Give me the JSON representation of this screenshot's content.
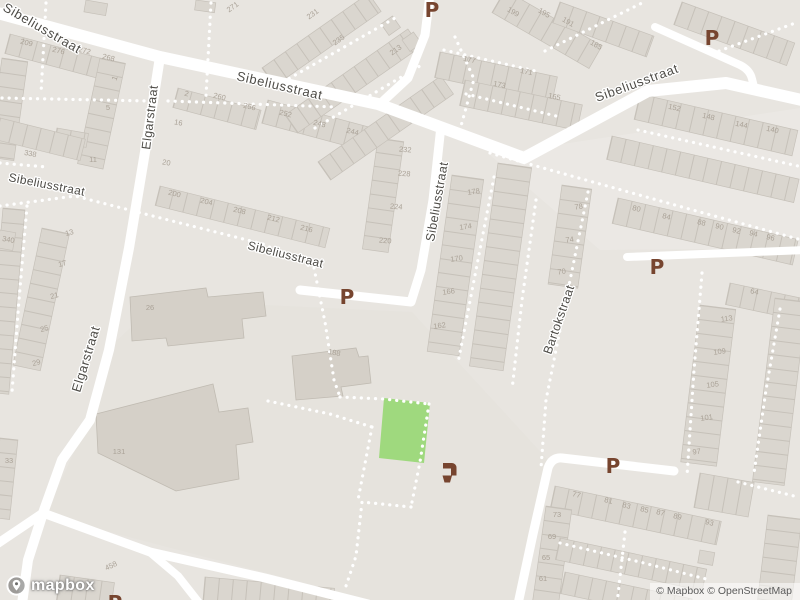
{
  "map_overlays": {
    "logo_text": "mapbox",
    "attribution_text": "© Mapbox © OpenStreetMap"
  },
  "colors": {
    "parking": "#77452f",
    "amenity": "#77452f",
    "park": "#9fd97e",
    "road": "#ffffff",
    "street_label": "#4e4c47",
    "house_number": "#aaa297"
  },
  "street_labels": [
    {
      "text": "Sibeliusstraat",
      "x": 2,
      "y": 10,
      "rotate": 30,
      "size": 13,
      "spacing": 0.7
    },
    {
      "text": "Sibeliusstraat",
      "x": 236,
      "y": 80,
      "rotate": 13,
      "size": 13,
      "spacing": 0.7
    },
    {
      "text": "Sibeliusstraat",
      "x": 597,
      "y": 102,
      "rotate": -20,
      "size": 13,
      "spacing": 0.7
    },
    {
      "text": "Sibeliusstraat",
      "x": 8,
      "y": 181,
      "rotate": 11,
      "size": 12,
      "spacing": 0.4
    },
    {
      "text": "Sibeliusstraat",
      "x": 247,
      "y": 249,
      "rotate": 14,
      "size": 12,
      "spacing": 0.4
    },
    {
      "text": "Sibeliusstraat",
      "x": 434,
      "y": 242,
      "rotate": -80,
      "size": 12.5,
      "spacing": 0.4
    },
    {
      "text": "Elgarstraat",
      "x": 150,
      "y": 150,
      "rotate": -83,
      "size": 12.5,
      "spacing": 0.4
    },
    {
      "text": "Elgarstraat",
      "x": 80,
      "y": 393,
      "rotate": -73,
      "size": 13,
      "spacing": 0.5
    },
    {
      "text": "Bartokstraat",
      "x": 551,
      "y": 355,
      "rotate": -71,
      "size": 12.5,
      "spacing": 0.4
    }
  ],
  "parking_glyph": "P",
  "parking_labels": [
    {
      "x": 432,
      "y": 10
    },
    {
      "x": 712,
      "y": 38
    },
    {
      "x": 347,
      "y": 297
    },
    {
      "x": 657,
      "y": 267
    },
    {
      "x": 613,
      "y": 466
    },
    {
      "x": 115,
      "y": 603
    }
  ],
  "amenity_icons": [
    {
      "name": "drinking-water-icon",
      "x": 452,
      "y": 472
    }
  ],
  "house_numbers": [
    {
      "t": "209",
      "x": 26,
      "y": 45,
      "r": 14
    },
    {
      "t": "276",
      "x": 58,
      "y": 53,
      "r": 14
    },
    {
      "t": "272",
      "x": 84,
      "y": 53,
      "r": 14
    },
    {
      "t": "268",
      "x": 108,
      "y": 60,
      "r": 14
    },
    {
      "t": "1",
      "x": 117,
      "y": 79,
      "r": -70
    },
    {
      "t": "5",
      "x": 108,
      "y": 110,
      "r": 0
    },
    {
      "t": "11",
      "x": 93,
      "y": 162,
      "r": 0
    },
    {
      "t": "338",
      "x": 30,
      "y": 156,
      "r": 10
    },
    {
      "t": "2",
      "x": 186,
      "y": 96,
      "r": 14
    },
    {
      "t": "260",
      "x": 219,
      "y": 99,
      "r": 14
    },
    {
      "t": "256",
      "x": 249,
      "y": 109,
      "r": 14
    },
    {
      "t": "16",
      "x": 178,
      "y": 125,
      "r": 10
    },
    {
      "t": "20",
      "x": 166,
      "y": 165,
      "r": 10
    },
    {
      "t": "200",
      "x": 174,
      "y": 196,
      "r": 14
    },
    {
      "t": "204",
      "x": 206,
      "y": 204,
      "r": 14
    },
    {
      "t": "208",
      "x": 239,
      "y": 213,
      "r": 14
    },
    {
      "t": "212",
      "x": 273,
      "y": 221,
      "r": 14
    },
    {
      "t": "216",
      "x": 306,
      "y": 231,
      "r": 14
    },
    {
      "t": "252",
      "x": 285,
      "y": 116,
      "r": 14
    },
    {
      "t": "248",
      "x": 319,
      "y": 126,
      "r": 14
    },
    {
      "t": "244",
      "x": 352,
      "y": 134,
      "r": 14
    },
    {
      "t": "232",
      "x": 405,
      "y": 152,
      "r": 5
    },
    {
      "t": "228",
      "x": 404,
      "y": 176,
      "r": 5
    },
    {
      "t": "224",
      "x": 396,
      "y": 209,
      "r": 5
    },
    {
      "t": "220",
      "x": 385,
      "y": 243,
      "r": 5
    },
    {
      "t": "13",
      "x": 70,
      "y": 235,
      "r": -15
    },
    {
      "t": "17",
      "x": 63,
      "y": 266,
      "r": -15
    },
    {
      "t": "21",
      "x": 55,
      "y": 298,
      "r": -15
    },
    {
      "t": "25",
      "x": 45,
      "y": 331,
      "r": -15
    },
    {
      "t": "29",
      "x": 37,
      "y": 365,
      "r": -15
    },
    {
      "t": "340",
      "x": 8,
      "y": 242,
      "r": 10
    },
    {
      "t": "33",
      "x": 9,
      "y": 463,
      "r": 0
    },
    {
      "t": "26",
      "x": 150,
      "y": 310,
      "r": 0
    },
    {
      "t": "131",
      "x": 119,
      "y": 454,
      "r": 0
    },
    {
      "t": "188",
      "x": 334,
      "y": 355,
      "r": 10
    },
    {
      "t": "458",
      "x": 112,
      "y": 568,
      "r": -25
    },
    {
      "t": "271",
      "x": 234,
      "y": 9,
      "r": -35
    },
    {
      "t": "231",
      "x": 314,
      "y": 16,
      "r": -35
    },
    {
      "t": "235",
      "x": 340,
      "y": 42,
      "r": -35
    },
    {
      "t": "213",
      "x": 397,
      "y": 52,
      "r": -35
    },
    {
      "t": "199",
      "x": 512,
      "y": 14,
      "r": 30
    },
    {
      "t": "195",
      "x": 543,
      "y": 15,
      "r": 30
    },
    {
      "t": "191",
      "x": 567,
      "y": 24,
      "r": 30
    },
    {
      "t": "185",
      "x": 595,
      "y": 47,
      "r": 30
    },
    {
      "t": "177",
      "x": 469,
      "y": 62,
      "r": 12
    },
    {
      "t": "171",
      "x": 526,
      "y": 74,
      "r": 12
    },
    {
      "t": "173",
      "x": 499,
      "y": 87,
      "r": 12
    },
    {
      "t": "165",
      "x": 554,
      "y": 99,
      "r": 12
    },
    {
      "t": "152",
      "x": 674,
      "y": 110,
      "r": 13
    },
    {
      "t": "148",
      "x": 708,
      "y": 119,
      "r": 13
    },
    {
      "t": "144",
      "x": 741,
      "y": 127,
      "r": 13
    },
    {
      "t": "140",
      "x": 772,
      "y": 132,
      "r": 13
    },
    {
      "t": "80",
      "x": 636,
      "y": 211,
      "r": 13
    },
    {
      "t": "84",
      "x": 666,
      "y": 219,
      "r": 13
    },
    {
      "t": "88",
      "x": 701,
      "y": 225,
      "r": 13
    },
    {
      "t": "90",
      "x": 719,
      "y": 229,
      "r": 13
    },
    {
      "t": "92",
      "x": 736,
      "y": 233,
      "r": 13
    },
    {
      "t": "94",
      "x": 753,
      "y": 236,
      "r": 13
    },
    {
      "t": "96",
      "x": 770,
      "y": 240,
      "r": 13
    },
    {
      "t": "78",
      "x": 579,
      "y": 209,
      "r": -8
    },
    {
      "t": "74",
      "x": 570,
      "y": 242,
      "r": -8
    },
    {
      "t": "70",
      "x": 562,
      "y": 274,
      "r": -8
    },
    {
      "t": "178",
      "x": 474,
      "y": 194,
      "r": -8
    },
    {
      "t": "174",
      "x": 466,
      "y": 229,
      "r": -8
    },
    {
      "t": "170",
      "x": 457,
      "y": 261,
      "r": -8
    },
    {
      "t": "166",
      "x": 449,
      "y": 294,
      "r": -8
    },
    {
      "t": "162",
      "x": 440,
      "y": 328,
      "r": -8
    },
    {
      "t": "64",
      "x": 754,
      "y": 294,
      "r": 12
    },
    {
      "t": "113",
      "x": 727,
      "y": 321,
      "r": -8
    },
    {
      "t": "109",
      "x": 720,
      "y": 354,
      "r": -8
    },
    {
      "t": "105",
      "x": 713,
      "y": 387,
      "r": -8
    },
    {
      "t": "101",
      "x": 707,
      "y": 420,
      "r": -8
    },
    {
      "t": "97",
      "x": 697,
      "y": 454,
      "r": -8
    },
    {
      "t": "77",
      "x": 576,
      "y": 497,
      "r": 13
    },
    {
      "t": "81",
      "x": 608,
      "y": 503,
      "r": 13
    },
    {
      "t": "83",
      "x": 626,
      "y": 508,
      "r": 13
    },
    {
      "t": "85",
      "x": 644,
      "y": 512,
      "r": 13
    },
    {
      "t": "87",
      "x": 660,
      "y": 515,
      "r": 13
    },
    {
      "t": "89",
      "x": 677,
      "y": 519,
      "r": 13
    },
    {
      "t": "93",
      "x": 709,
      "y": 525,
      "r": 13
    },
    {
      "t": "73",
      "x": 557,
      "y": 517,
      "r": 0
    },
    {
      "t": "69",
      "x": 552,
      "y": 539,
      "r": 0
    },
    {
      "t": "65",
      "x": 546,
      "y": 560,
      "r": 0
    },
    {
      "t": "61",
      "x": 543,
      "y": 581,
      "r": 0
    }
  ]
}
